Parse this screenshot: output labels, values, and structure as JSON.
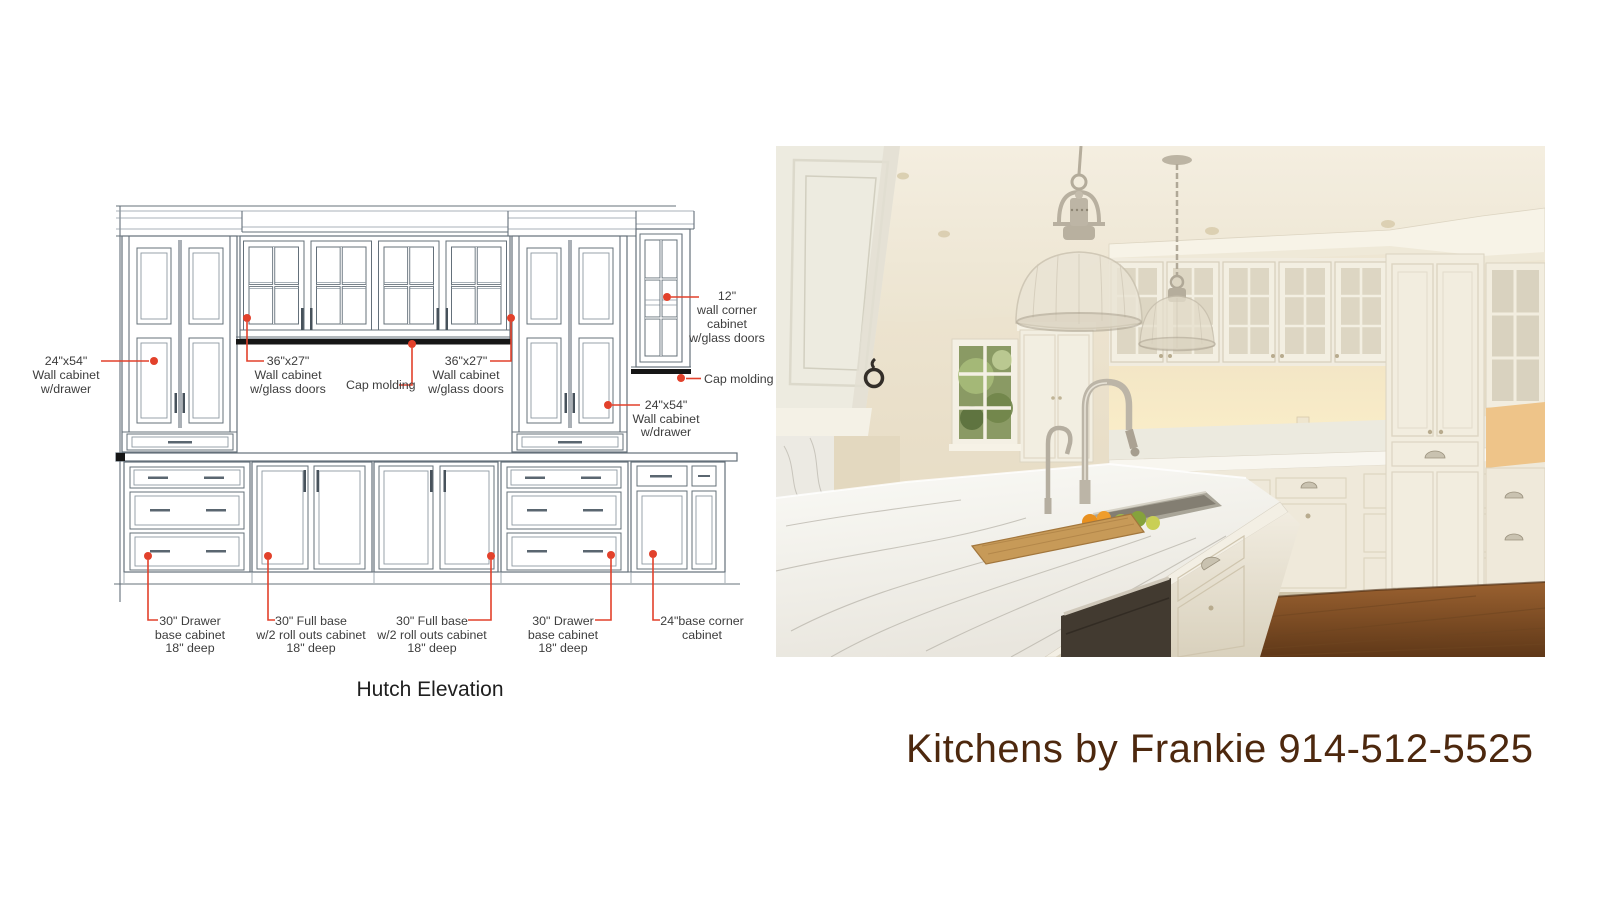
{
  "diagram": {
    "title": "Hutch Elevation",
    "colors": {
      "line": "#64707a",
      "annotation_red": "#e2412b",
      "label_text": "#3d3d3d",
      "cap_molding": "#161616"
    },
    "labels": [
      {
        "id": "wall-cabinet-left",
        "lines": [
          "24\"x54\"",
          "Wall cabinet",
          "w/drawer"
        ]
      },
      {
        "id": "wall-cabinet-glass-left",
        "lines": [
          "36\"x27\"",
          "Wall cabinet",
          "w/glass doors"
        ]
      },
      {
        "id": "cap-molding-center",
        "lines": [
          "Cap molding"
        ]
      },
      {
        "id": "wall-cabinet-glass-right",
        "lines": [
          "36\"x27\"",
          "Wall cabinet",
          "w/glass doors"
        ]
      },
      {
        "id": "wall-corner-cabinet",
        "lines": [
          "12\"",
          "wall corner",
          "cabinet",
          "w/glass doors"
        ]
      },
      {
        "id": "cap-molding-right",
        "lines": [
          "Cap molding"
        ]
      },
      {
        "id": "wall-cabinet-right",
        "lines": [
          "24\"x54\"",
          "Wall cabinet",
          "w/drawer"
        ]
      },
      {
        "id": "drawer-base-left",
        "lines": [
          "30\" Drawer",
          "base cabinet",
          "18\" deep"
        ]
      },
      {
        "id": "full-base-1",
        "lines": [
          "30\" Full base",
          "w/2 roll outs cabinet",
          "18\" deep"
        ]
      },
      {
        "id": "full-base-2",
        "lines": [
          "30\" Full base",
          "w/2 roll outs cabinet",
          "18\" deep"
        ]
      },
      {
        "id": "drawer-base-right",
        "lines": [
          "30\" Drawer",
          "base cabinet",
          "18\" deep"
        ]
      },
      {
        "id": "base-corner",
        "lines": [
          "24\"base corner",
          "cabinet"
        ]
      }
    ]
  },
  "photo": {
    "alt": "white kitchen with marble island, two glass pendant lights, glass-front upper cabinets, wood floor"
  },
  "footer": {
    "brand_text": "Kitchens by Frankie 914-512-5525",
    "text_color": "#4d280e"
  }
}
